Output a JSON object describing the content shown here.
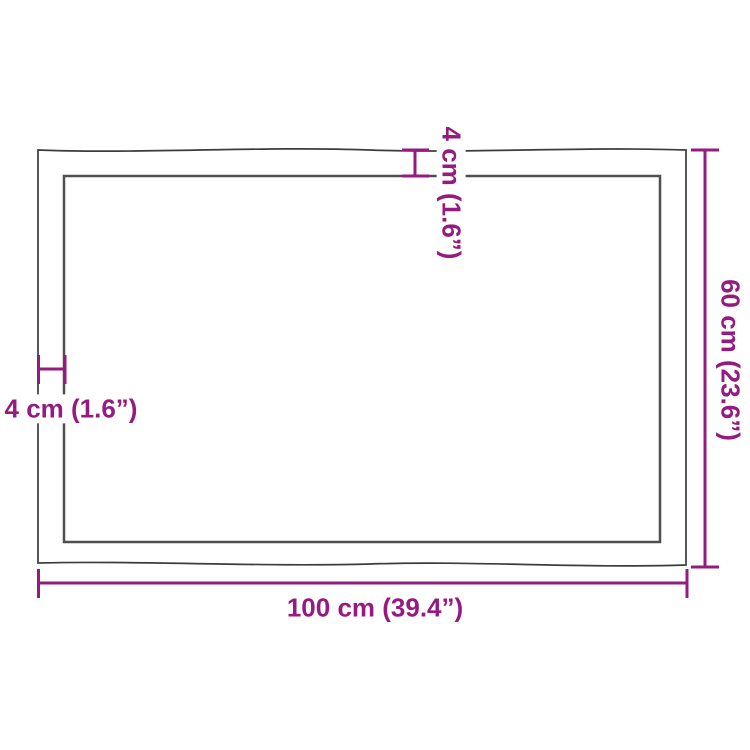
{
  "diagram": {
    "labels": {
      "length": "100 cm (39.4”)",
      "width": "60 cm (23.6”)",
      "thickness_top": "4 cm (1.6”)",
      "thickness_left": "4 cm (1.6”)"
    },
    "colors": {
      "dimension_accent": "#951b81",
      "outer_outline": "#3c3c3c",
      "inner_outline": "#4f4f4f",
      "background": "#ffffff"
    }
  }
}
